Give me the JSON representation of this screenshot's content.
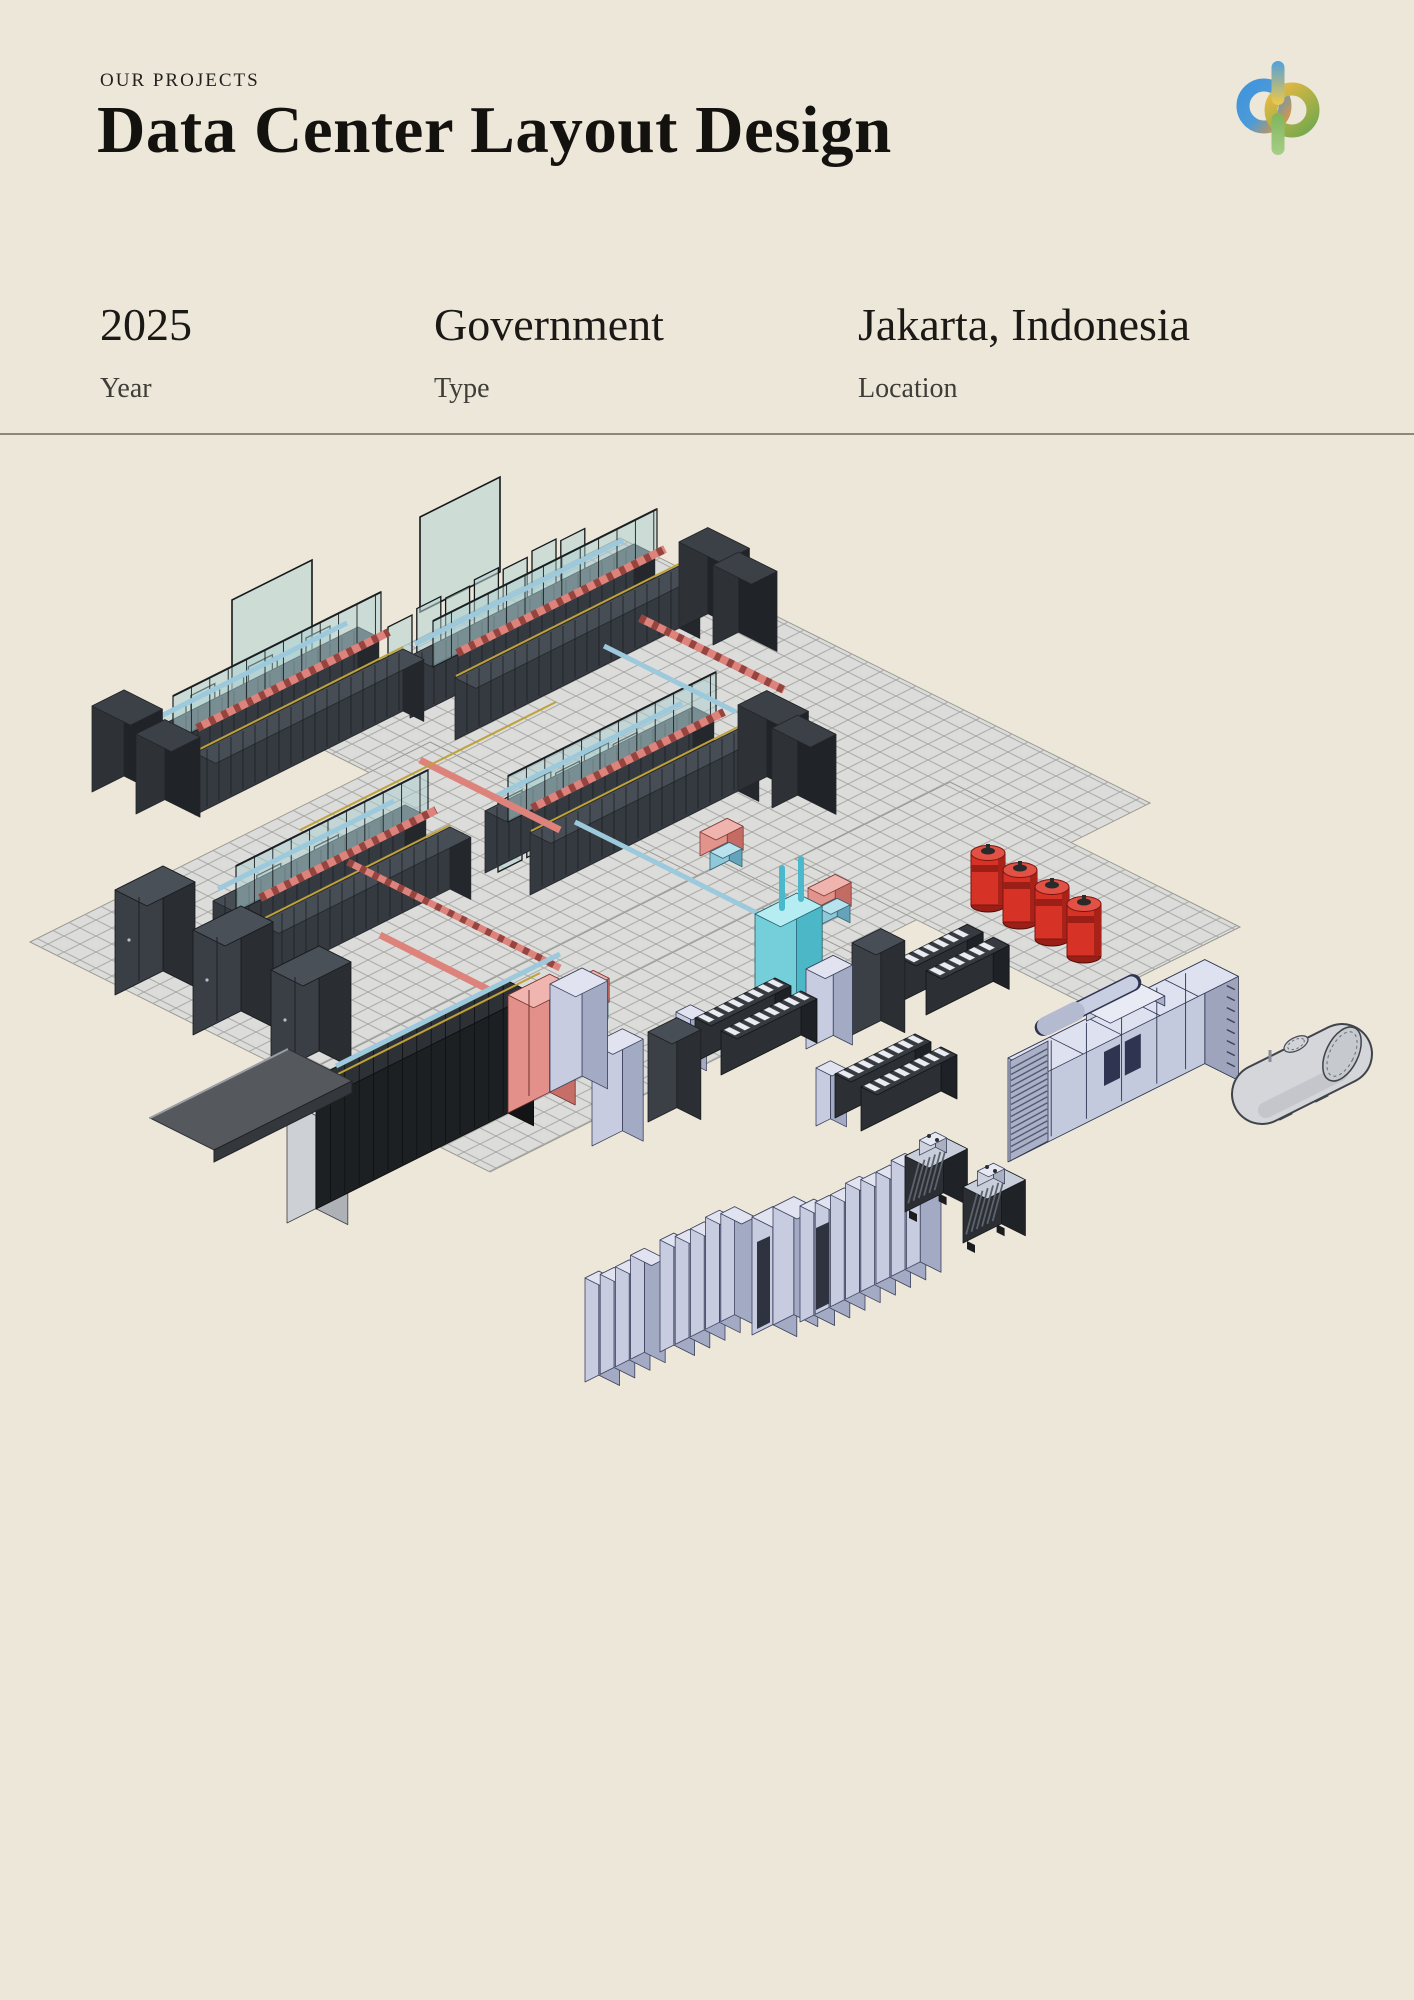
{
  "page": {
    "background": "#ede7da"
  },
  "header": {
    "eyebrow": "OUR PROJECTS",
    "title": "Data Center Layout Design"
  },
  "logo": {
    "name": "dp-monogram",
    "colors": {
      "blue": "#3f93dd",
      "orange": "#e0963a",
      "gold": "#edc84a",
      "green": "#6da84e"
    }
  },
  "meta": {
    "items": [
      {
        "value": "2025",
        "label": "Year"
      },
      {
        "value": "Government",
        "label": "Type"
      },
      {
        "value": "Jakarta, Indonesia",
        "label": "Location"
      }
    ]
  },
  "illustration": {
    "name": "data-center-isometric-render",
    "description": "Isometric BIM rendering of a data center layout: server rack rows with glass containment, hot (red) and cold (blue) piping, CRAC units, battery strings, UPS cabinets, fire-suppression tanks, switchgear lineup, transformers, diesel generator, fuel tank and access ramp on a raised-floor grid.",
    "equipment": [
      "raised-floor-grid",
      "containment-pods",
      "glass-partitions",
      "crac-units",
      "battery-strings",
      "ups-cabinets",
      "crah-unit-red",
      "crah-unit-cyan",
      "fire-suppression-tanks",
      "bottom-rack-row",
      "access-ramp",
      "switchgear-lineup",
      "transformers",
      "diesel-generator",
      "fuel-tank"
    ],
    "palette": {
      "floor": "#dcdcda",
      "grid_line": "#a9a9a7",
      "rack_dark": "#343a40",
      "rack_black": "#1d2023",
      "glass": "#aacfcf",
      "hot_pipe": "#dd837c",
      "cold_pipe": "#9cc9dc",
      "tray_yellow": "#bfa13a",
      "cyan_unit": "#74cfdb",
      "cabinet_lavender": "#c7cce0",
      "tank_red": "#d63226",
      "generator": "#c4cade",
      "fuel_tank": "#d4d6da"
    }
  }
}
